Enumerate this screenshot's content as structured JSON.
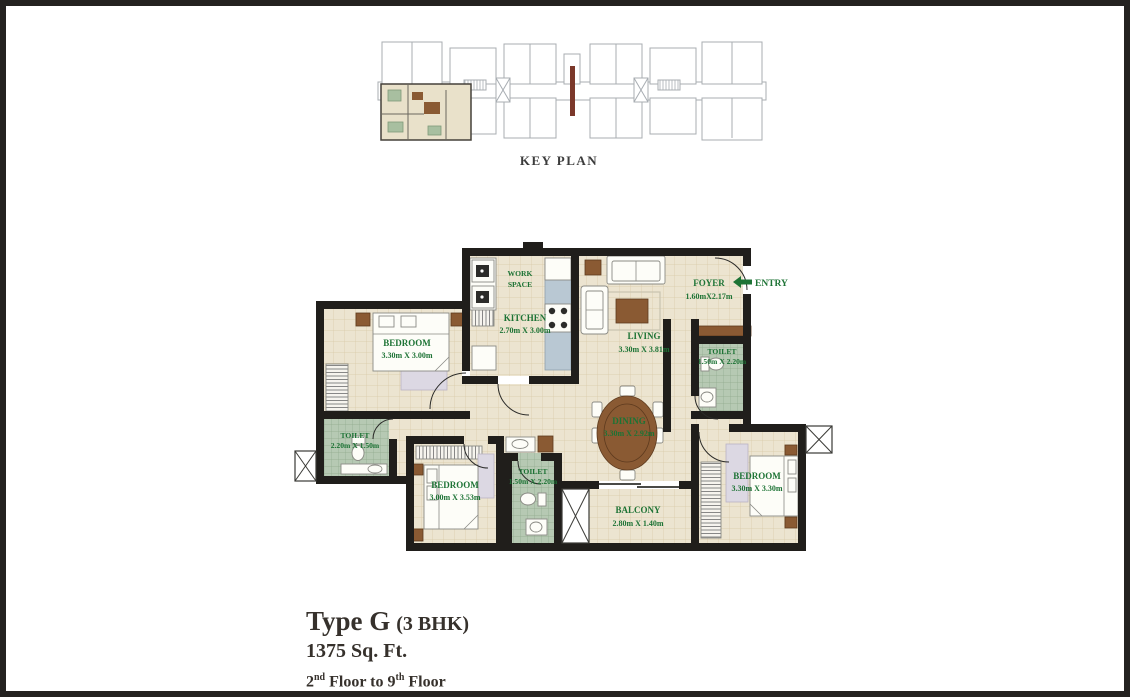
{
  "colors": {
    "frame": "#242220",
    "label_green": "#1d7335",
    "wall": "#201e1b",
    "floor_beige": "#ece4d0",
    "toilet_green": "#b6c9b3",
    "counter_blue": "#b9c8d3",
    "wood_brown": "#8a5a33",
    "keyplan_highlight": "#e9e1ca"
  },
  "key_plan": {
    "caption": "KEY PLAN"
  },
  "plan": {
    "entry_label": "ENTRY",
    "rooms": {
      "work_space": {
        "line1": "WORK",
        "line2": "SPACE"
      },
      "kitchen": {
        "name": "KITCHEN",
        "dims": "2.70m X 3.00m"
      },
      "bedroom_top_left": {
        "name": "BEDROOM",
        "dims": "3.30m X 3.00m"
      },
      "living": {
        "name": "LIVING",
        "dims": "3.30m X 3.81m"
      },
      "foyer": {
        "name": "FOYER",
        "dims": "1.60mX2.17m"
      },
      "toilet_right": {
        "name": "TOILET",
        "dims": "1.50m X 2.20m"
      },
      "dining": {
        "name": "DINING",
        "dims": "3.30m X 2.92m"
      },
      "toilet_left": {
        "name": "TOILET",
        "dims": "2.20m X 1.50m"
      },
      "bedroom_center": {
        "name": "BEDROOM",
        "dims": "3.00m X 3.53m"
      },
      "toilet_center": {
        "name": "TOILET",
        "dims": "1.50m X 2.20m"
      },
      "balcony": {
        "name": "BALCONY",
        "dims": "2.80m X 1.40m"
      },
      "bedroom_right": {
        "name": "BEDROOM",
        "dims": "3.30m X 3.30m"
      }
    }
  },
  "footer": {
    "unit_type": "Type G",
    "unit_config": "(3 BHK)",
    "area": "1375 Sq. Ft.",
    "floor_from_num": "2",
    "floor_from_sup": "nd",
    "floor_mid": " Floor to ",
    "floor_to_num": "9",
    "floor_to_sup": "th",
    "floor_suffix": " Floor"
  }
}
